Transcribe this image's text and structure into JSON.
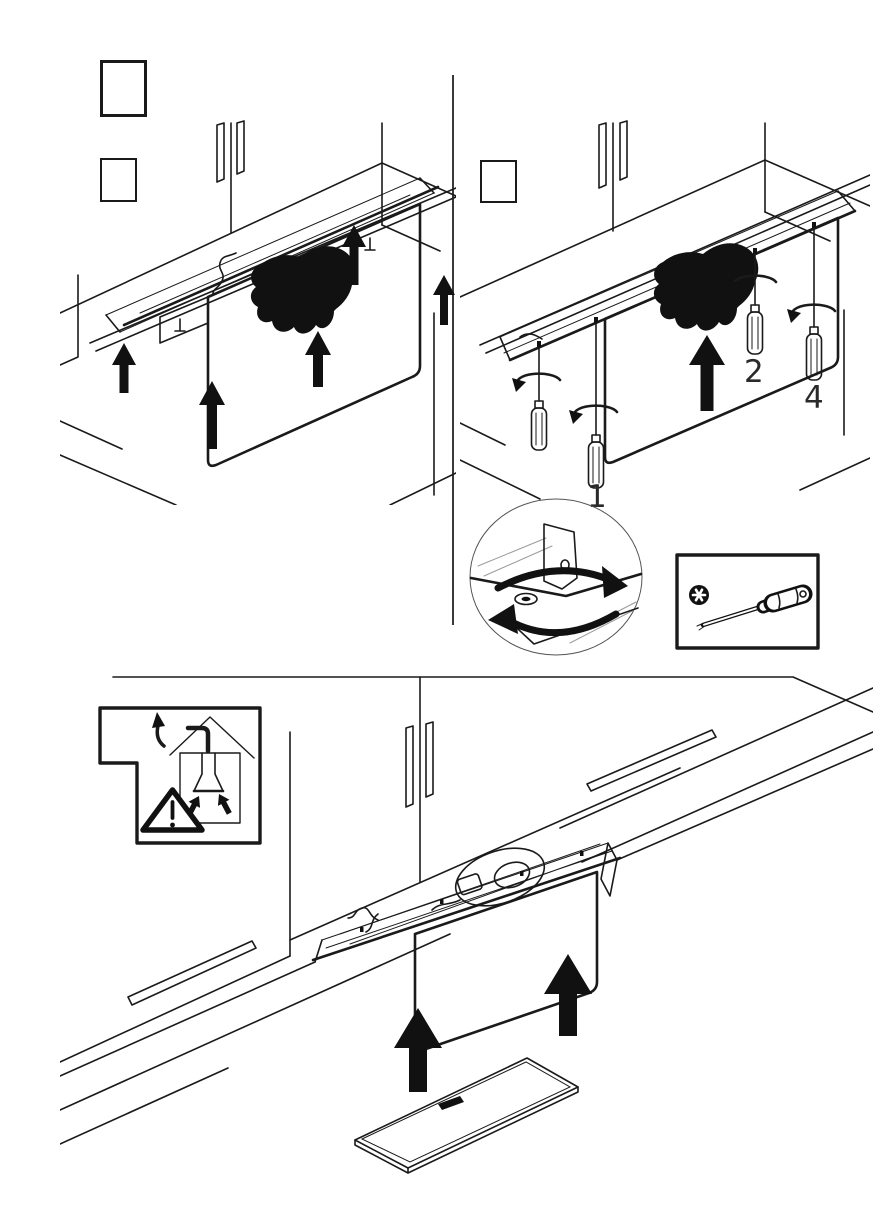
{
  "colors": {
    "background": "#ffffff",
    "line": "#1a1a1a",
    "solid_fill": "#111111",
    "light_line": "#9a9a9a"
  },
  "labels": {
    "screw_1": "1",
    "screw_2": "2",
    "screw_4": "4"
  },
  "step_boxes": {
    "top_left_large": "",
    "top_left_small": "",
    "top_right": ""
  },
  "icons": [
    "hand-press-icon",
    "up-arrow-icon",
    "rotation-arrow-icon",
    "screwdriver-icon",
    "torx-screw-icon",
    "torx-screwdriver-icon",
    "warning-triangle-icon",
    "exhaust-duct-house-icon",
    "extractor-funnel-icon",
    "detail-circle-view"
  ]
}
